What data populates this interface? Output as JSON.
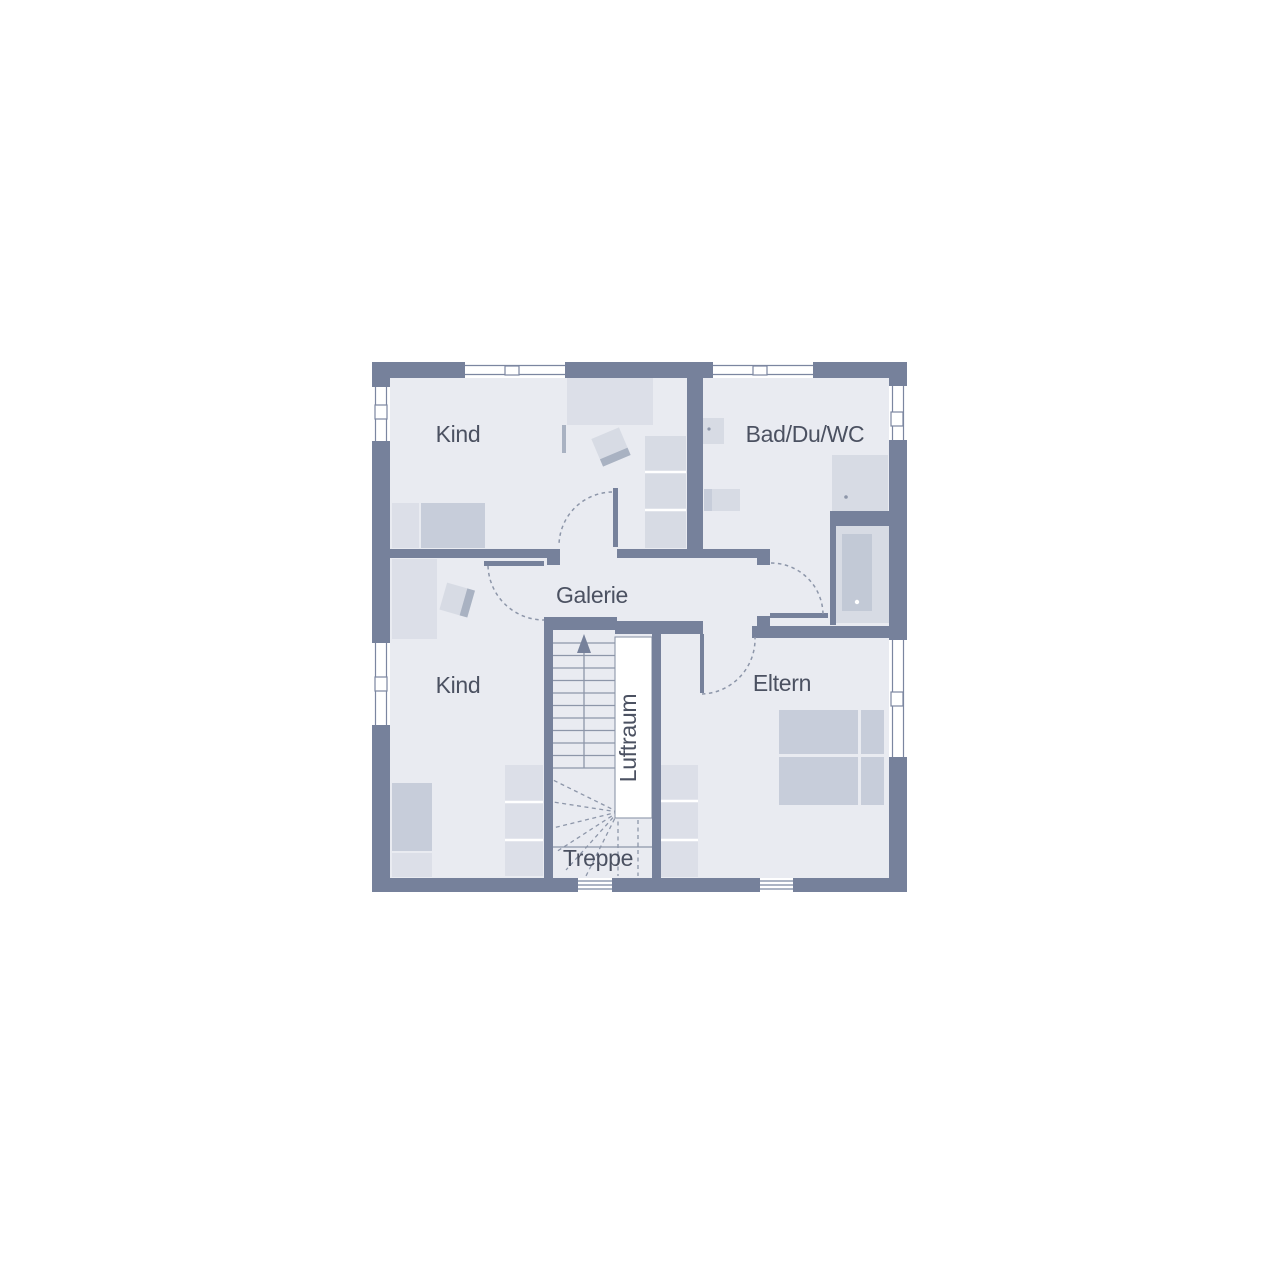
{
  "plan": {
    "type": "floor-plan",
    "rooms": {
      "kind_top": {
        "label": "Kind"
      },
      "bad": {
        "label": "Bad/Du/WC"
      },
      "galerie": {
        "label": "Galerie"
      },
      "kind_bottom": {
        "label": "Kind"
      },
      "eltern": {
        "label": "Eltern"
      }
    },
    "stairs": {
      "treppe_label": "Treppe",
      "luftraum_label": "Luftraum"
    }
  },
  "colors": {
    "wall": "#76819b",
    "floor": "#e9ebf1",
    "furniture_light": "#dcdfe8",
    "furniture_mid": "#c7cdda",
    "furniture_dark": "#a9b2c2",
    "fixture": "#d7dbe4",
    "tub_inner": "#c2c9d6",
    "line": "#8d96a9",
    "frame": "#7b86a0",
    "window": "#ffffff",
    "text": "#4b5161"
  }
}
